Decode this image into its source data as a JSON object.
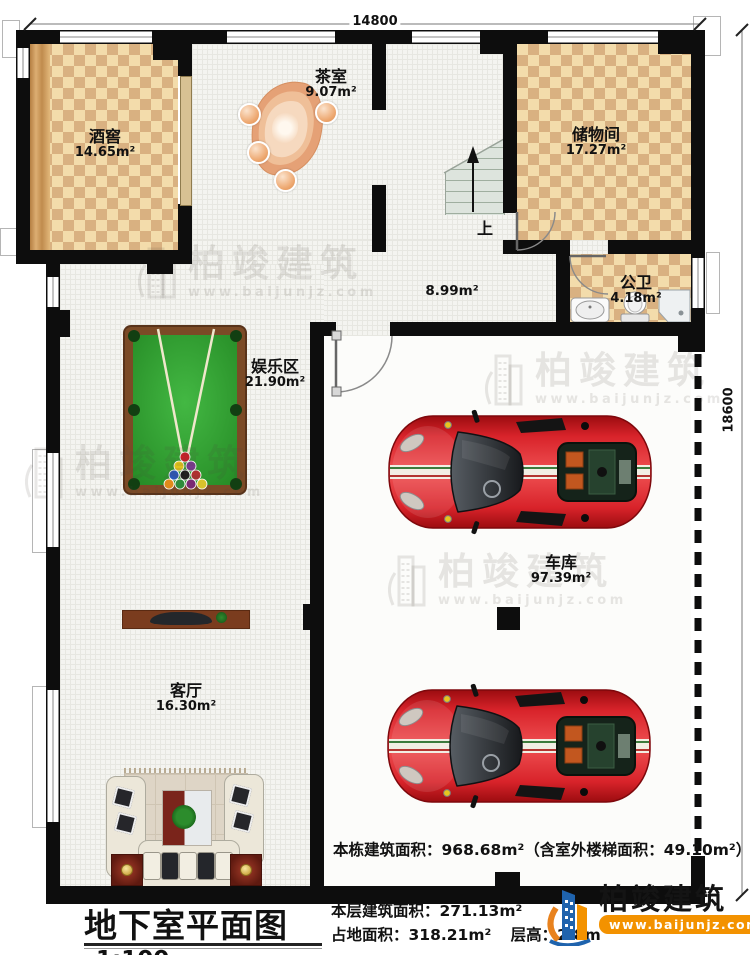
{
  "title": {
    "text": "地下室平面图",
    "scale": "1:100"
  },
  "dimensions": {
    "top": "14800",
    "right": "18600"
  },
  "rooms": [
    {
      "name": "酒窖",
      "area": "14.65m²"
    },
    {
      "name": "茶室",
      "area": "9.07m²"
    },
    {
      "name": "储物间",
      "area": "17.27m²"
    },
    {
      "name": "公卫",
      "area": "4.18m²"
    },
    {
      "name": "娱乐区",
      "area": "21.90m²"
    },
    {
      "name": "客厅",
      "area": "16.30m²"
    },
    {
      "name": "车库",
      "area": "97.39m²"
    }
  ],
  "corridor": {
    "area": "8.99m²"
  },
  "stairs": {
    "up_label": "上"
  },
  "stats": {
    "line1": "本栋建筑面积：968.68m²（含室外楼梯面积：49.10m²）",
    "line2": "本层建筑面积：271.13m²",
    "line3_footprint": "占地面积：318.21m²",
    "line3_height": "层高：2.8m"
  },
  "logo": {
    "name": "柏竣建筑",
    "url": "www.baijunjz.com"
  },
  "watermark": {
    "name": "柏竣建筑",
    "url": "www.baijunjz.com"
  },
  "colors": {
    "wall": "#0d0d0d",
    "checker_light": "#f3dcab",
    "checker_dark": "#d9b181",
    "floor": "#f4f4f0",
    "felt_green": "#2f9e31",
    "table_frame": "#7b4a26",
    "car_red": "#d8232a",
    "logo_orange": "#f39200",
    "logo_blue": "#1f63ad"
  }
}
